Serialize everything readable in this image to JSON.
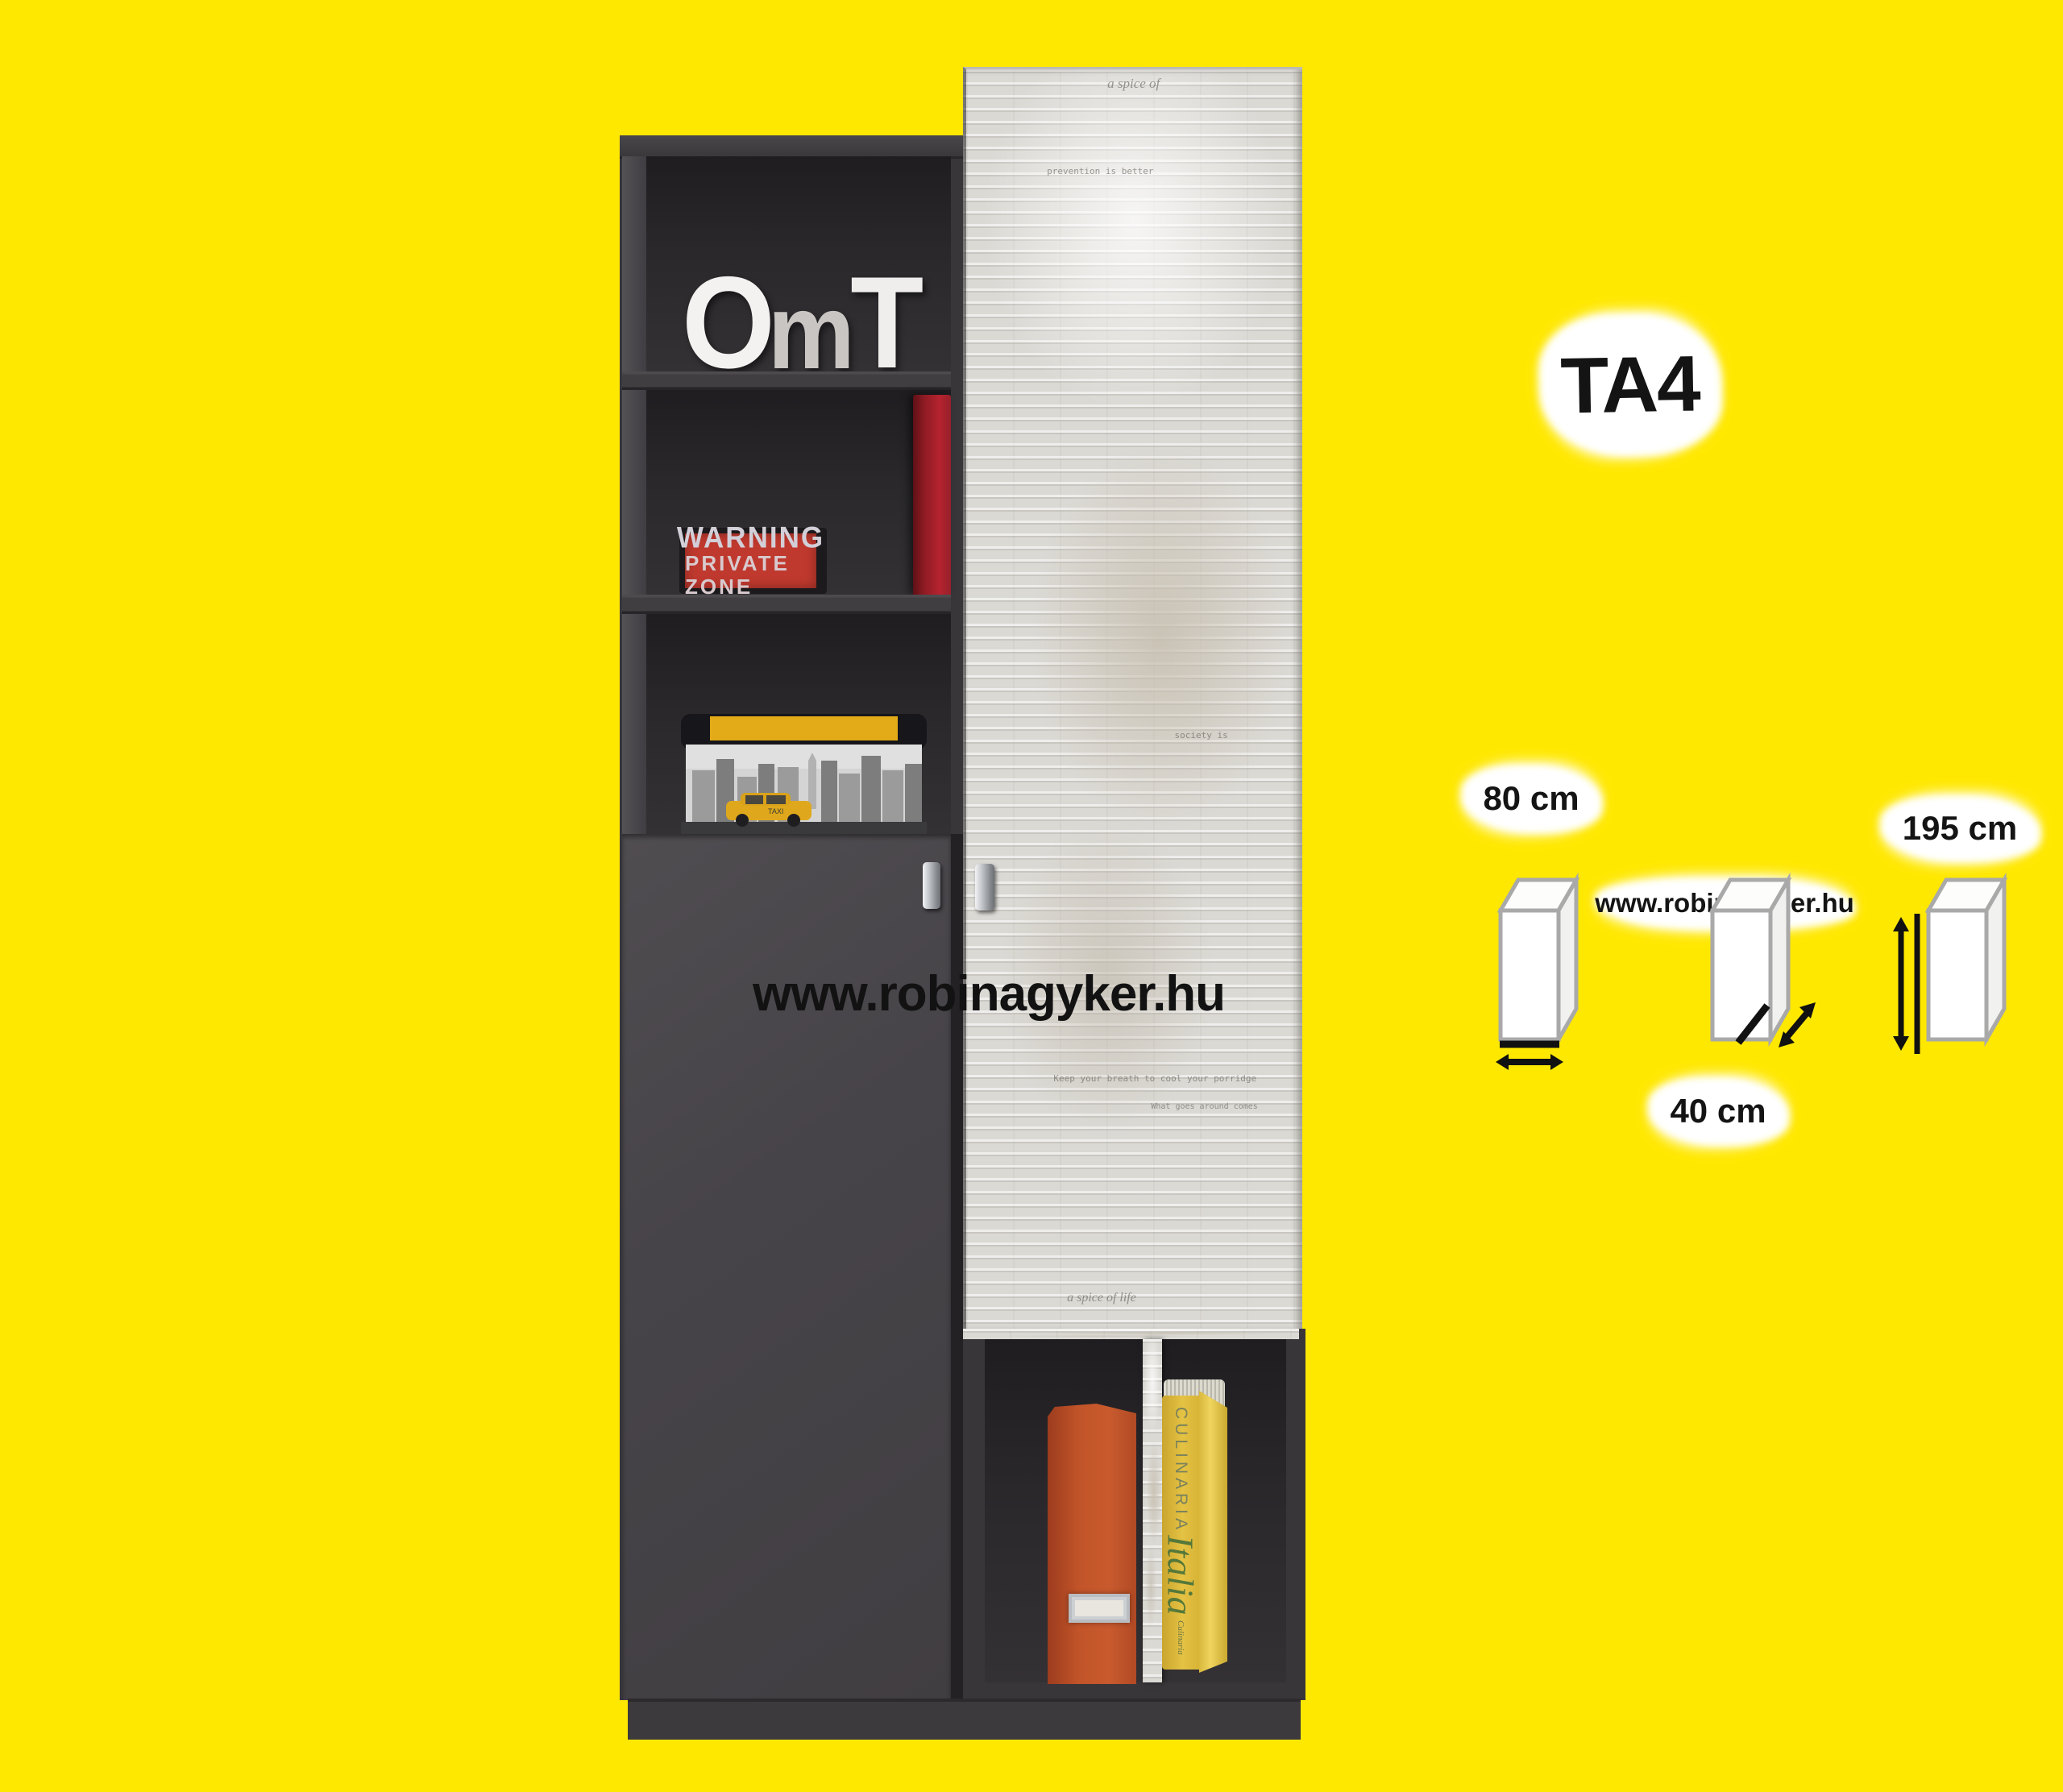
{
  "colors": {
    "background": "#ffe800",
    "carcass_dark": "#39363a",
    "door_graphite": "#474449",
    "newsprint_light": "#dbd9d4",
    "sign_red": "#c0392e",
    "box_lid_yellow": "#e2ab17",
    "folder_orange": "#c85a2e",
    "book_yellow": "#e4c243"
  },
  "annotations": {
    "product_code": "TA4",
    "watermark": "www.robinagyker.hu",
    "site_label": "www.robinagyker.hu",
    "dim_width": "80 cm",
    "dim_depth": "40 cm",
    "dim_height": "195 cm"
  },
  "furniture": {
    "decor_letters": {
      "o": "O",
      "m": "m",
      "t": "T"
    },
    "warning_sign": {
      "line1": "WARNING",
      "line2": "PRIVATE ZONE"
    },
    "storage_box": {
      "taxi_label": "TAXI"
    },
    "yellow_book": {
      "spine_top": "CULINARIA",
      "spine_title": "Italia",
      "spine_footer": "Culinaria"
    },
    "newsprint_phrases": [
      "a spice of",
      "prevention is better",
      "Keep your breath to cool your porridge",
      "What goes around comes",
      "society is",
      "a spice of life"
    ]
  }
}
